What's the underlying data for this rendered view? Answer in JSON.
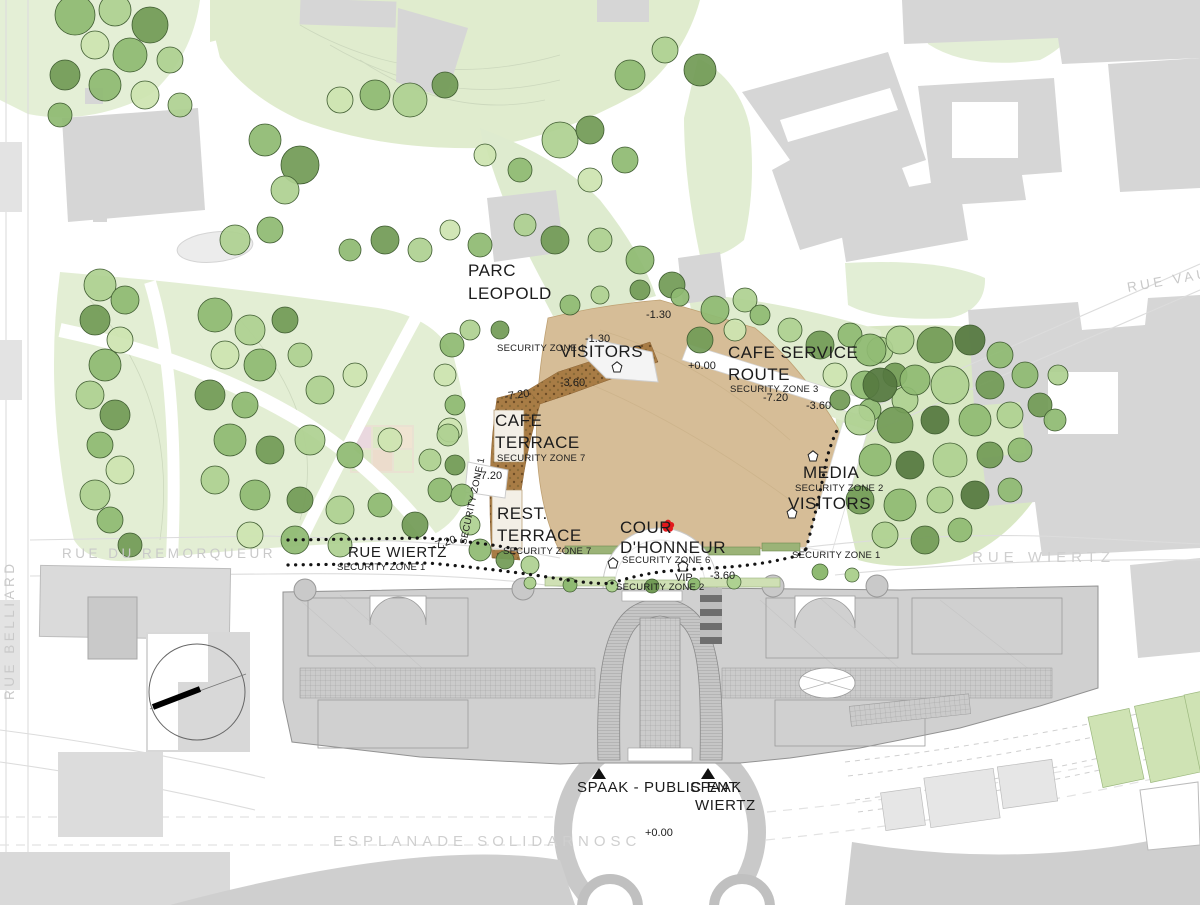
{
  "title": "Parc Leopold / Spaak building site plan",
  "colors": {
    "lawn": "#e3eed4",
    "lawn_dark": "#d7e8c2",
    "plaza": "#d6bd97",
    "terrace_band": "#a87c45",
    "building": "#d6d6d6",
    "spaak": "#d0d0d0",
    "accent_red": "#e3191d",
    "road_text": "#cbcbcb",
    "dot_black": "#141414"
  },
  "labels": {
    "parc_line1": "PARC",
    "parc_line2": "LEOPOLD",
    "sz1_visitors": "SECURITY ZONE 1",
    "visitors_north": "VISITORS",
    "lvl_m130_a": "-1.30",
    "lvl_m130_b": "-1.30",
    "lvl_p000_route": "+0.00",
    "lvl_m360_plaza": "-3.60",
    "cafe_service1": "CAFE SERVICE",
    "cafe_service2": "ROUTE",
    "sz3": "SECURITY ZONE 3",
    "lvl_m720_route": "-7.20",
    "lvl_m360_route": "-3.60",
    "lvl_m720_cafe": "-7.20",
    "cafe1": "CAFE",
    "cafe2": "TERRACE",
    "sz7_cafe": "SECURITY ZONE 7",
    "lvl_m720_path": "-7.20",
    "sz1_path": "SECURITY ZONE 1",
    "rest1": "REST.",
    "rest2": "TERRACE",
    "sz7_rest": "SECURITY ZONE 7",
    "media": "MEDIA",
    "sz2_media": "SECURITY ZONE 2",
    "visitors_media": "VISITORS",
    "cour1": "COUR",
    "cour2": "D'HONNEUR",
    "sz6": "SECURITY ZONE 6",
    "vip": "VIP",
    "lvl_m360_vip": "-3.60",
    "sz2_road": "SECURITY ZONE 2",
    "rue_wiertz_w": "RUE WIERTZ",
    "sz1_w": "SECURITY ZONE 1",
    "lvl_m720_road": "-7.20",
    "rue_du_remorqueur": "RUE DU REMORQUEUR",
    "sz1_e": "SECURITY ZONE 1",
    "rue_wiertz_e": "RUE WIERTZ",
    "rue_vau": "RUE VAU",
    "rue_belliard": "RUE BELLIARD",
    "spaak_public": "SPAAK - PUBLIC ENT.",
    "spaak_w1": "SPAAK",
    "spaak_w2": "WIERTZ",
    "esplanade": "ESPLANADE SOLIDARNOSC",
    "lvl_p000_esp": "+0.00"
  }
}
